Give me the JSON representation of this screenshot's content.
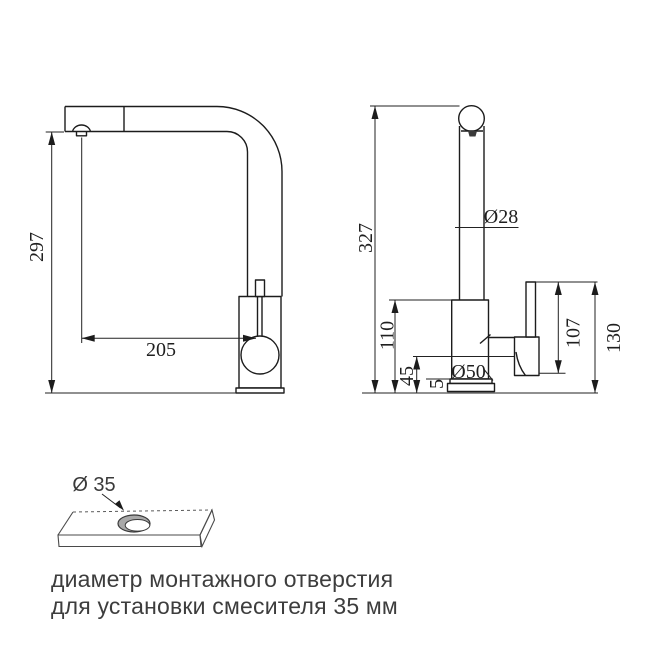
{
  "diagram": {
    "front_view": {
      "dim_height": "297",
      "dim_spout_reach": "205"
    },
    "side_view": {
      "dim_total_height": "327",
      "dim_spout_diameter": "Ø28",
      "dim_body_height": "110",
      "dim_lower_section_height": "45",
      "dim_base_plate_thickness": "5",
      "dim_base_diameter": "Ø50",
      "dim_handle_length": "107",
      "dim_handle_top_height": "130"
    },
    "mounting_hole": {
      "dim_hole_diameter": "Ø 35",
      "caption_line1": "диаметр монтажного отверстия",
      "caption_line2": "для установки смесителя 35 мм"
    }
  }
}
